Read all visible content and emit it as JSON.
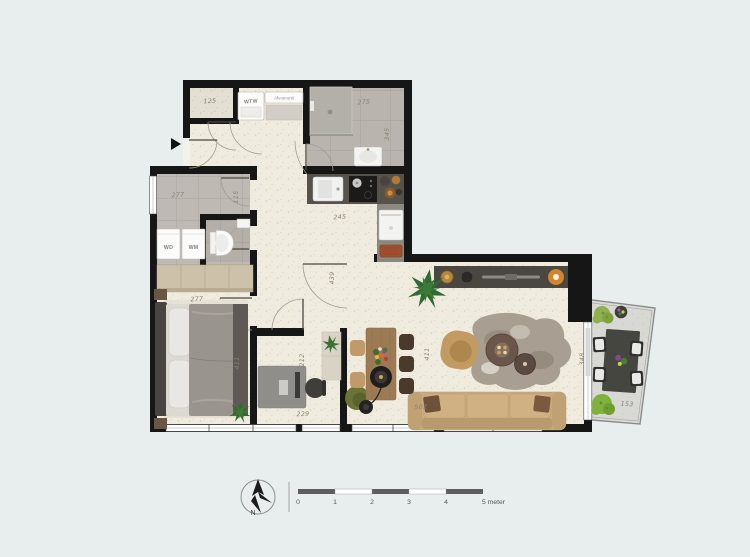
{
  "plan": {
    "dims": {
      "closet": "125",
      "storage_w": "277",
      "storage_h": "115",
      "bathroom_w": "275",
      "bathroom_h": "345",
      "kitchen": "245",
      "corridor": "439",
      "bedroom_w": "277",
      "bedroom_h": "411",
      "office_h": "212",
      "office_w": "229",
      "living_h": "411",
      "living_w": "502",
      "balcony_h": "348",
      "balcony_w": "153"
    },
    "units": {
      "wtw": "WTW",
      "afvoer": "Afvoerunit",
      "washer_dryer": "WD",
      "washing_machine": "WM"
    }
  },
  "legend": {
    "compass_n": "N",
    "scale_ticks": [
      "0",
      "1",
      "2",
      "3",
      "4"
    ],
    "scale_end": "5 meter"
  },
  "colors": {
    "background": "#e8edee",
    "wall": "#161616",
    "floor": "#efe9dc",
    "tile": "#bdb9b2",
    "balcony_floor": "#d8d8d5",
    "counter": "#55524c",
    "sofa": "#c9ab7e",
    "wood": "#9c7a54",
    "plant": "#2f6b33",
    "accent_orange": "#d2862a",
    "dim_text": "#8c8272",
    "scale_dark": "#5e5e5e"
  }
}
